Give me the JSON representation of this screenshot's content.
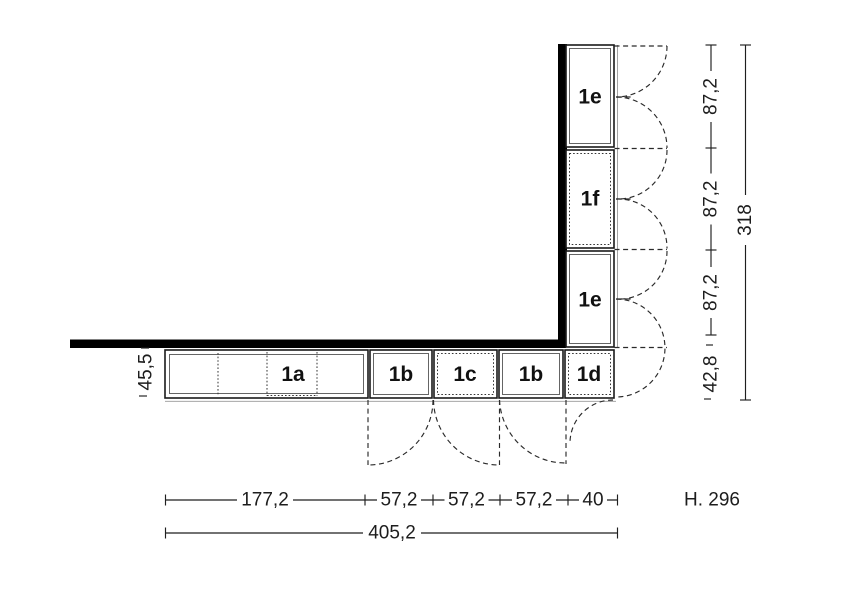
{
  "units": {
    "stack": [
      "1e",
      "1f",
      "1e"
    ],
    "row": [
      "1a",
      "1b",
      "1c",
      "1b",
      "1d"
    ]
  },
  "dims": {
    "bottom": [
      "177,2",
      "57,2",
      "57,2",
      "57,2",
      "40"
    ],
    "bottom_total": "405,2",
    "right": [
      "87,2",
      "87,2",
      "87,2",
      "42,8"
    ],
    "right_total": "318",
    "side": "45,5",
    "height_label": "H. 296"
  }
}
